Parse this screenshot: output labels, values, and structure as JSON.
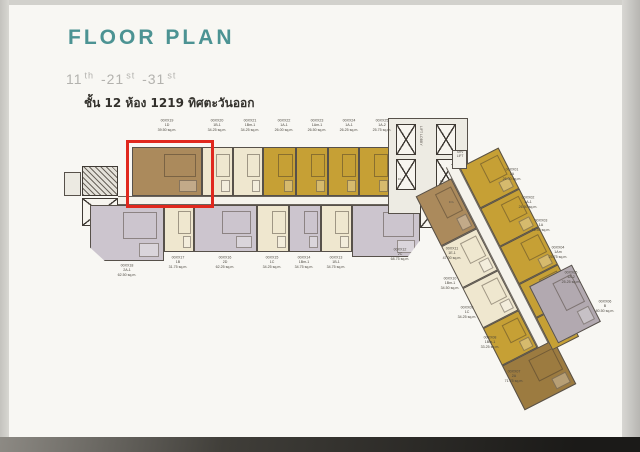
{
  "header": {
    "title": "FLOOR PLAN",
    "floors": [
      {
        "n": "11",
        "s": "th"
      },
      {
        "n": "-21",
        "s": "st"
      },
      {
        "n": "-31",
        "s": "st"
      }
    ],
    "caption": "ชั้น 12 ห้อง 1219 ทิศตะวันออก"
  },
  "core": {
    "lift_lobby": "LIFT LOBBY",
    "srv_lift": "SRV\nLIFT",
    "el_1": "EL.",
    "el_2": "EL.",
    "es": "ES."
  },
  "units": {
    "top": [
      {
        "id": "00XX19",
        "type": "1D",
        "area": "39.50 sq.m."
      },
      {
        "id": "00XX20",
        "type": "1B-1",
        "area": "34.25 sq.m."
      },
      {
        "id": "00XX21",
        "type": "1Bm-1",
        "area": "34.25 sq.m."
      },
      {
        "id": "00XX22",
        "type": "1A-1",
        "area": "26.00 sq.m."
      },
      {
        "id": "00XX23",
        "type": "1Am-1",
        "area": "26.50 sq.m."
      },
      {
        "id": "00XX24",
        "type": "1A-1",
        "area": "26.25 sq.m."
      },
      {
        "id": "00XX25",
        "type": "1A-2",
        "area": "25.75 sq.m."
      }
    ],
    "bottom": [
      {
        "id": "00XX18",
        "type": "2A-1",
        "area": "62.50 sq.m."
      },
      {
        "id": "00XX17",
        "type": "1B",
        "area": "31.75 sq.m."
      },
      {
        "id": "00XX16",
        "type": "2D",
        "area": "62.25 sq.m."
      },
      {
        "id": "00XX15",
        "type": "1C",
        "area": "34.25 sq.m."
      },
      {
        "id": "00XX14",
        "type": "1Bm-1",
        "area": "34.75 sq.m."
      },
      {
        "id": "00XX13",
        "type": "1B-1",
        "area": "34.75 sq.m."
      },
      {
        "id": "00XX12",
        "type": "2C",
        "area": "68.75 sq.m."
      },
      {
        "id": "00XX11",
        "type": "1E-1",
        "area": "47.00 sq.m."
      }
    ],
    "wing_left": [
      {
        "id": "00XX10",
        "type": "1Bm-1",
        "area": "34.50 sq.m."
      },
      {
        "id": "00XX09",
        "type": "1C",
        "area": "34.25 sq.m."
      },
      {
        "id": "00XX08",
        "type": "1Bm-1",
        "area": "33.25 sq.m."
      },
      {
        "id": "00XX07",
        "type": "2A",
        "area": "71.75 sq.m."
      }
    ],
    "wing_right": [
      {
        "id": "00XX01",
        "type": "1A",
        "area": "26.00 sq.m."
      },
      {
        "id": "00XX02",
        "type": "1A-1",
        "area": "26.50 sq.m."
      },
      {
        "id": "00XX03",
        "type": "1A",
        "area": "26.50 sq.m."
      },
      {
        "id": "00XX04",
        "type": "1Am",
        "area": "25.75 sq.m."
      },
      {
        "id": "00XX05",
        "type": "1A-2",
        "area": "25.25 sq.m."
      },
      {
        "id": "00XX06",
        "type": "B",
        "area": "80.50 sq.m."
      }
    ]
  },
  "colors": {
    "title_teal": "#4c9393",
    "highlight_red": "#e0281e",
    "unit_cream": "#efe7cf",
    "unit_gold": "#c6a035",
    "unit_brown": "#ab8a5c",
    "unit_lavender": "#ccc5ce",
    "unit_gray": "#b2a9b0"
  }
}
